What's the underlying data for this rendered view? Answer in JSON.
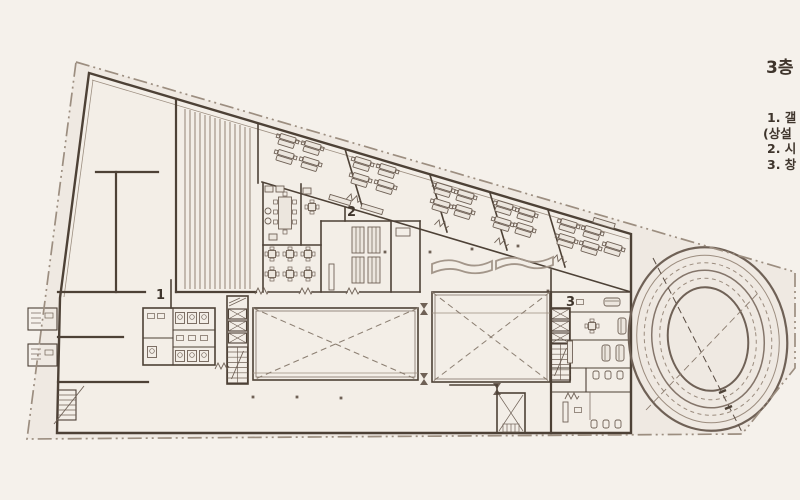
{
  "legend": {
    "title": "3층",
    "lines": [
      "1. 갤",
      "(상설",
      "2. 시",
      "3. 창"
    ]
  },
  "plan": {
    "labels": [
      {
        "text": "1"
      },
      {
        "text": "2"
      },
      {
        "text": "3"
      }
    ]
  },
  "colors": {
    "bg": "#f5f1eb",
    "site": "#efe9e2",
    "building": "#f3eee7",
    "wall": "#4d4136",
    "wall-light": "#9c8e80",
    "furniture": "#6f6156",
    "accent-light": "#a3968a",
    "text": "#3f352c"
  }
}
